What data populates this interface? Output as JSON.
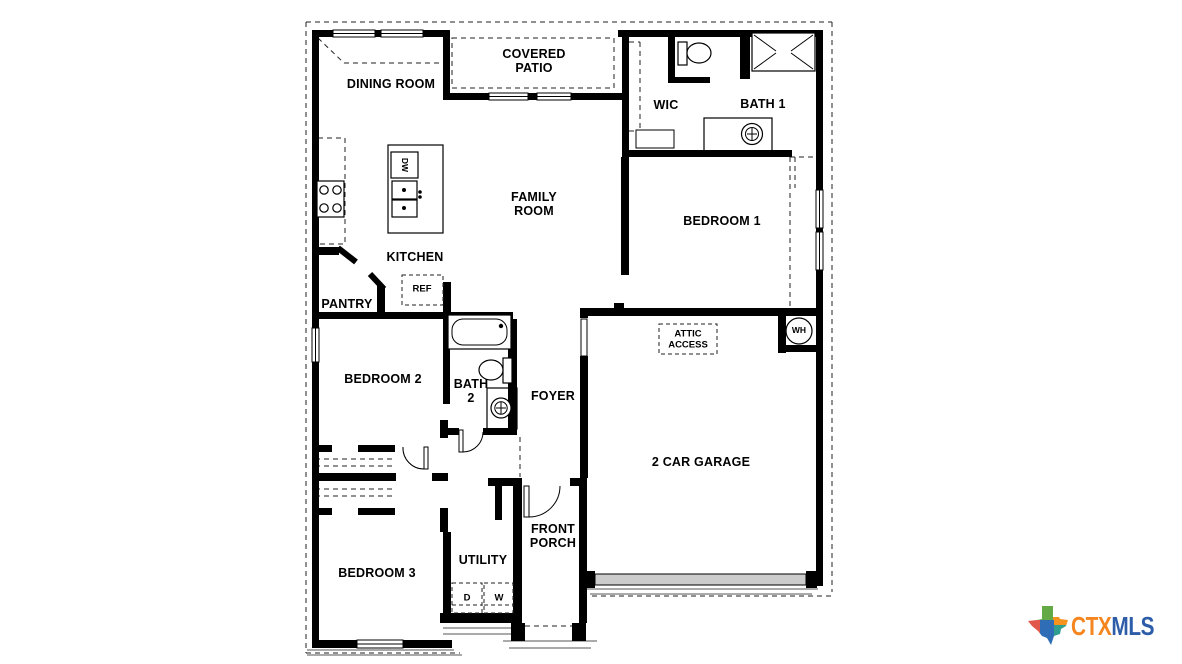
{
  "plan": {
    "rooms": {
      "dining_room": "DINING ROOM",
      "covered_patio": "COVERED\nPATIO",
      "wic": "WIC",
      "bath_1": "BATH 1",
      "family_room": "FAMILY\nROOM",
      "bedroom_1": "BEDROOM 1",
      "kitchen": "KITCHEN",
      "pantry": "PANTRY",
      "bedroom_2": "BEDROOM 2",
      "bath_2": "BATH\n2",
      "foyer": "FOYER",
      "garage": "2 CAR GARAGE",
      "front_porch": "FRONT\nPORCH",
      "utility": "UTILITY",
      "bedroom_3": "BEDROOM 3"
    },
    "fixtures": {
      "dishwasher": "DW",
      "refrigerator": "REF",
      "attic_access": "ATTIC\nACCESS",
      "water_heater": "WH",
      "dryer": "D",
      "washer": "W"
    }
  },
  "logo": {
    "ctx": "CTX",
    "mls": "MLS"
  },
  "colors": {
    "walls": "#000000",
    "background": "#ffffff",
    "garage_door": "#cccccc",
    "logo_ctx_text": "#f5861f",
    "logo_mls_text": "#2d5ca8",
    "texas_green": "#63a945",
    "texas_orange": "#f6921e",
    "texas_red": "#e1584b",
    "texas_blue": "#2f6eb6",
    "texas_teal": "#2f9e8f"
  }
}
